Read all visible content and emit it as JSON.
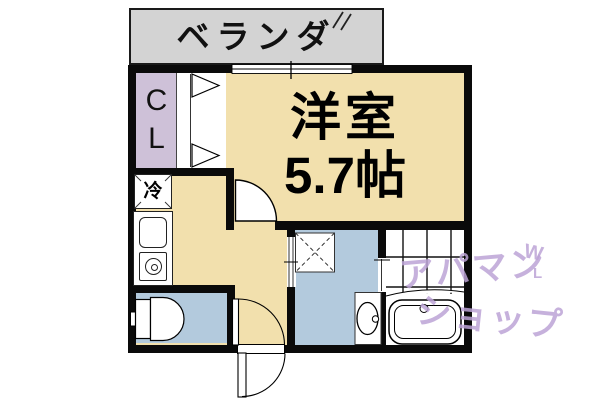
{
  "floorplan": {
    "balcony": {
      "label": "ベランダ"
    },
    "closet": {
      "label": "CL"
    },
    "main_room": {
      "name": "洋室",
      "size": "5.7帖"
    },
    "kitchen": {
      "refrigerator_label": "冷"
    },
    "watermark": {
      "line1": "アパマン",
      "line2": "ショップ",
      "mark_top": "W",
      "mark_side": "L"
    },
    "colors": {
      "room_floor": "#f2e0ad",
      "closet": "#cec1d8",
      "water_area": "#b3cadd",
      "balcony": "#d3d3d3",
      "wall": "#0a0a0a",
      "watermark": "#bca3d6"
    }
  }
}
